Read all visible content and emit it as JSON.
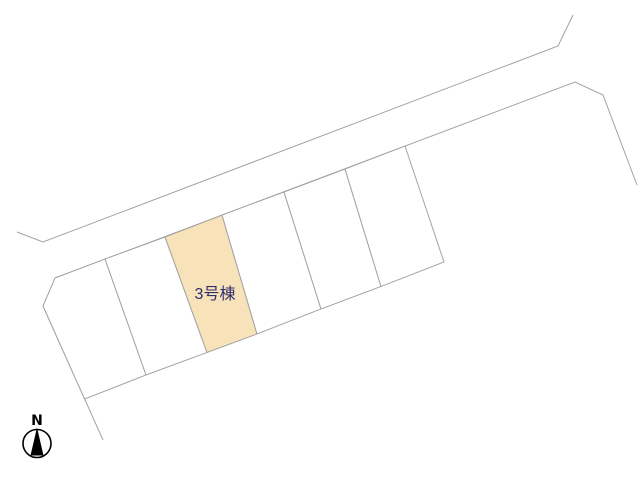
{
  "title": "site-plan",
  "colors": {
    "background": "#ffffff",
    "line": "#a3a3a3",
    "lot_fill": "#ffffff",
    "highlight_fill": "#f7e2b9",
    "label_text": "#2f2f70",
    "compass": "#000000"
  },
  "site_plan": {
    "highlighted_lot_label": "3号棟",
    "road_lines": [
      {
        "name": "road-line-upper",
        "points": "17,232 43,242 558,46 573,15"
      },
      {
        "name": "road-line-lower",
        "points": "55,278 575,82 603,95 637,185"
      },
      {
        "name": "road-line-west",
        "points": "43,306 103,440"
      }
    ],
    "lots": [
      {
        "name": "lot-1",
        "points": "55,278 105,259 146,375 84.6,399 43,306",
        "highlighted": false
      },
      {
        "name": "lot-2",
        "points": "105,259 165,237 207,352.5 146,375",
        "highlighted": false
      },
      {
        "name": "lot-3",
        "points": "165,237 222,215 257,334 207,352.5",
        "highlighted": true,
        "label": "3号棟"
      },
      {
        "name": "lot-4",
        "points": "222,215 284,192 321,309 257,334",
        "highlighted": false
      },
      {
        "name": "lot-5",
        "points": "284,192 345,169 381,286.5 321,309",
        "highlighted": false
      },
      {
        "name": "lot-6",
        "points": "345,169 405,146 444,262 381,286.5",
        "highlighted": false
      }
    ]
  },
  "compass": {
    "label": "N"
  }
}
